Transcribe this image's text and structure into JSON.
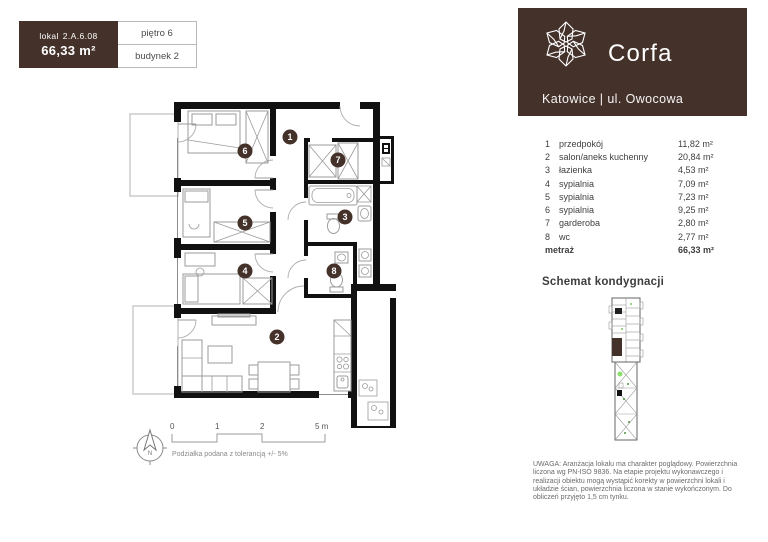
{
  "unit": {
    "label_lokal": "lokal",
    "number": "2.A.6.08",
    "area": "66,33 m²",
    "floor": "piętro 6",
    "building": "budynek 2"
  },
  "brand": {
    "name": "Corfa",
    "location": "Katowice | ul. Owocowa"
  },
  "rooms": [
    {
      "no": "1",
      "name": "przedpokój",
      "area": "11,82 m²"
    },
    {
      "no": "2",
      "name": "salon/aneks kuchenny",
      "area": "20,84 m²"
    },
    {
      "no": "3",
      "name": "łazienka",
      "area": "4,53 m²"
    },
    {
      "no": "4",
      "name": "sypialnia",
      "area": "7,09 m²"
    },
    {
      "no": "5",
      "name": "sypialnia",
      "area": "7,23 m²"
    },
    {
      "no": "6",
      "name": "sypialnia",
      "area": "9,25 m²"
    },
    {
      "no": "7",
      "name": "garderoba",
      "area": "2,80 m²"
    },
    {
      "no": "8",
      "name": "wc",
      "area": "2,77 m²"
    }
  ],
  "total": {
    "label": "metraż",
    "area": "66,33 m²"
  },
  "schematic": {
    "title": "Schemat kondygnacji"
  },
  "plan": {
    "markers": [
      {
        "n": "1"
      },
      {
        "n": "6"
      },
      {
        "n": "7"
      },
      {
        "n": "5"
      },
      {
        "n": "3"
      },
      {
        "n": "4"
      },
      {
        "n": "8"
      },
      {
        "n": "2"
      }
    ],
    "scale_ticks": [
      "0",
      "1",
      "2",
      "5 m"
    ],
    "scale_note": "Podziałka podana z tolerancją +/- 5%",
    "compass": "N"
  },
  "disclaimer": "UWAGA: Aranżacja lokalu ma charakter poglądowy.  Powierzchnia liczona wg PN-ISO 9836.  Na etapie projektu wykonawczego i realizacji obiektu mogą wystąpić korekty w powierzchni lokali i układzie ścian, powierzchnia liczona w stanie wykończonym.  Do obliczeń przyjęto 1,5 cm tynku.",
  "colors": {
    "brand_brown": "#44312a",
    "wall_black": "#111111",
    "furniture_gray": "#9b9b9b",
    "balcony_gray": "#cfcfcf",
    "accent_green": "#7cc95e"
  }
}
